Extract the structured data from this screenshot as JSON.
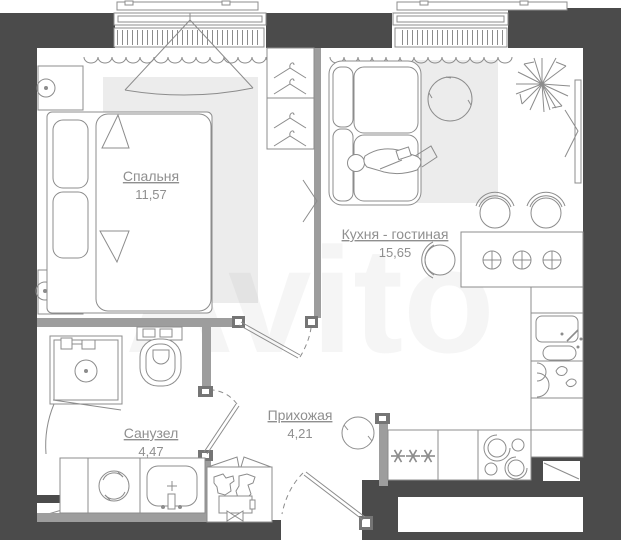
{
  "plan": {
    "watermark": "Avito",
    "rooms": [
      {
        "id": "bedroom",
        "name": "Спальня",
        "area": "11,57"
      },
      {
        "id": "kitchen_living",
        "name": "Кухня - гостиная",
        "area": "15,65"
      },
      {
        "id": "bathroom",
        "name": "Санузел",
        "area": "4,47"
      },
      {
        "id": "hallway",
        "name": "Прихожая",
        "area": "4,21"
      }
    ],
    "colors": {
      "wall_dark": "#4b4b4b",
      "wall_gray": "#9d9d9d",
      "line": "#8c8c8c",
      "rug": "#ececec",
      "label": "#8f8f8f",
      "background": "#ffffff"
    }
  }
}
